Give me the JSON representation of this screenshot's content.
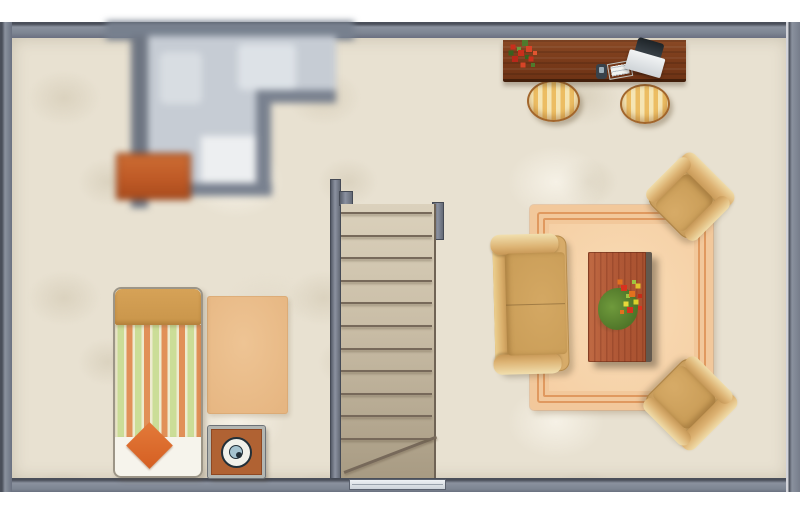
{
  "scene": {
    "kind": "floor-plan",
    "blurred_region": "bathroom-top-left"
  },
  "palette": {
    "wall": "#7e8694",
    "floor": "#e8e1d1",
    "living_rug": "#f2c89b",
    "living_rug_border": "#e0995f",
    "upholstery_tan": "#d7ab69",
    "coffee_table_wood": "#b25a38",
    "desk_wood": "#7b3c1b",
    "bed_stripe_green": "#cbdd97",
    "bed_stripe_orange": "#e19058",
    "cushion_orange": "#d96426",
    "dresser_orange": "#bc5a26",
    "stool_stripe_amber": "#ecbd63",
    "bathroom_floor": "#c6ccd4",
    "stair_tread": "#c9bda6"
  },
  "stairs": {
    "steps": 11,
    "has_winder": true,
    "label": "staircase"
  },
  "objects": {
    "bathroom": {
      "label": "bathroom (blurred)"
    },
    "dresser": {
      "label": "dresser"
    },
    "desk": {
      "label": "desk"
    },
    "desk_flowers": {
      "label": "flower pot"
    },
    "laptop": {
      "label": "laptop"
    },
    "papers": {
      "label": "notepad"
    },
    "phone": {
      "label": "phone"
    },
    "stool_left": {
      "label": "stool"
    },
    "stool_right": {
      "label": "stool"
    },
    "living_rug": {
      "label": "area rug"
    },
    "sofa": {
      "label": "sofa"
    },
    "chair_top": {
      "label": "armchair"
    },
    "chair_bottom": {
      "label": "armchair"
    },
    "coffee_table": {
      "label": "coffee table"
    },
    "bouquet": {
      "label": "flower bouquet"
    },
    "bed": {
      "label": "bed"
    },
    "cushion": {
      "label": "cushion"
    },
    "bedroom_rug": {
      "label": "bedroom rug"
    },
    "nightstand": {
      "label": "nightstand"
    },
    "disc": {
      "label": "speaker"
    },
    "window": {
      "label": "window"
    }
  }
}
